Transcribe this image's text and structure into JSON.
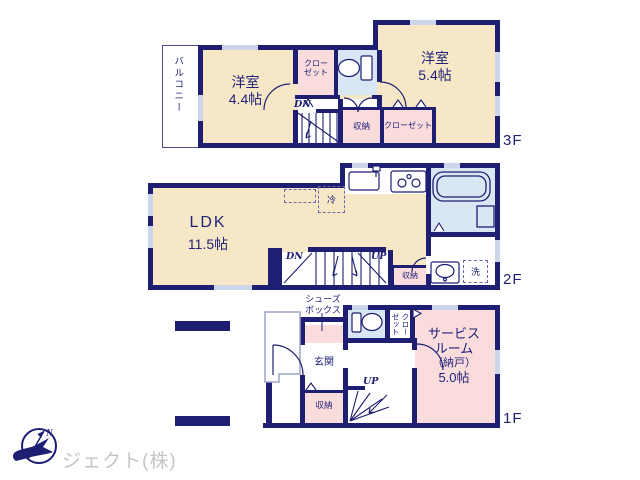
{
  "colors": {
    "wall_navy": "#1e1e72",
    "room_cream": "#f6e8c6",
    "closet_pink": "#fadcdc",
    "bath_blue": "#d9e7f4",
    "window_gray": "#ccd6ea",
    "logo_gray": "#c5c5c5"
  },
  "floor3f": {
    "floor_label": "3F",
    "balcony": "バルコニー",
    "room_a_name": "洋室",
    "room_a_size": "4.4帖",
    "closet_upper_line1": "クロー",
    "closet_upper_line2": "ゼット",
    "stairs_down": "DN",
    "storage": "収納",
    "closet_lower": "クローゼット",
    "room_b_name": "洋室",
    "room_b_size": "5.4帖"
  },
  "floor2f": {
    "floor_label": "2F",
    "ldk_name": "LDK",
    "ldk_size": "11.5帖",
    "refrigerator": "冷",
    "stairs_down": "DN",
    "stairs_up": "UP",
    "storage": "収納",
    "laundry": "洗"
  },
  "floor1f": {
    "floor_label": "1F",
    "shoebox_line1": "シューズ",
    "shoebox_line2": "ボックス",
    "entrance": "玄関",
    "storage": "収納",
    "stairs_up": "UP",
    "closet_vertical": "クローゼット",
    "service_line1": "サービス",
    "service_line2": "ルーム",
    "service_line3": "（納戸）",
    "service_line4": "5.0帖"
  },
  "logo": {
    "company": "ジェクト(株)",
    "compass_north": "N"
  }
}
